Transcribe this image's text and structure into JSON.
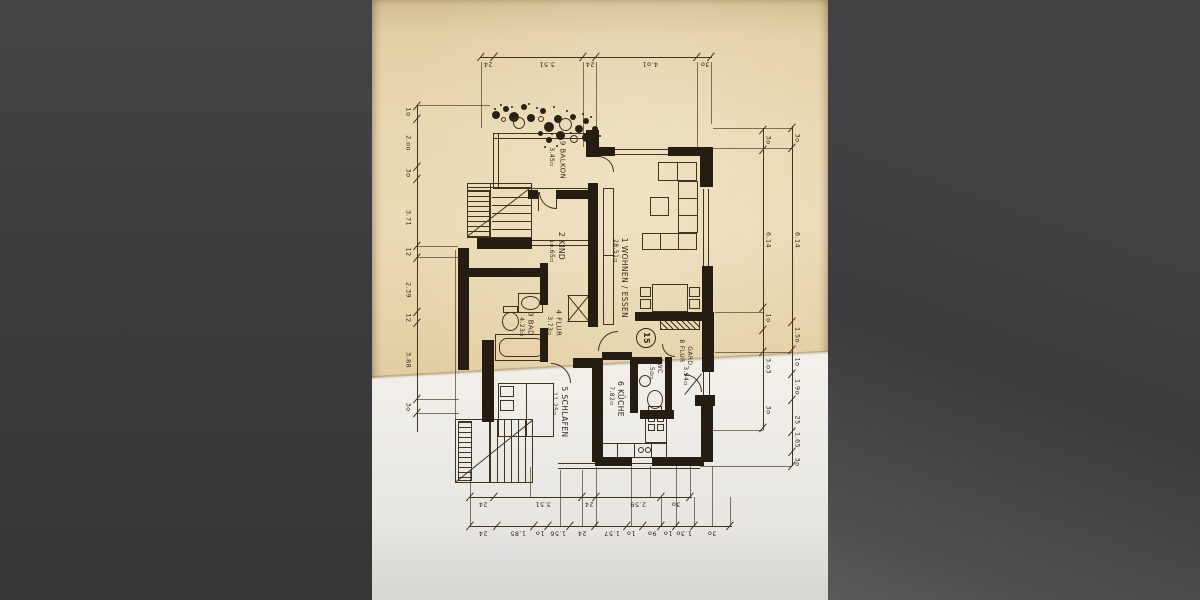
{
  "scene": {
    "description": "photograph of a folded German apartment floor-plan letter, unit 15",
    "letterbox_color": "#3d3d3f",
    "paper_tan": "#e8d4ab",
    "paper_white": "#efede9",
    "ink": "#33281a"
  },
  "unit_badge": {
    "label": "15",
    "x": 646,
    "y": 338,
    "r": 10
  },
  "rooms": [
    {
      "key": "balkon",
      "name": "9 BALKON",
      "area": "3.45▫",
      "nx": 562,
      "ny": 160,
      "ax": 551,
      "ay": 157,
      "fs": 7
    },
    {
      "key": "kind",
      "name": "2 KIND",
      "area": "1o.65▫",
      "nx": 561,
      "ny": 246,
      "ax": 551,
      "ay": 251,
      "fs": 7.5
    },
    {
      "key": "wohnen",
      "name": "1 WOHNEN / ESSEN",
      "area": "28.51▫",
      "nx": 624,
      "ny": 278,
      "ax": 615,
      "ay": 251,
      "fs": 7.5
    },
    {
      "key": "flur",
      "name": "4 FLUR",
      "area": "3.73▫",
      "nx": 558,
      "ny": 323,
      "ax": 549,
      "ay": 326,
      "fs": 7
    },
    {
      "key": "bad",
      "name": "3 BAD",
      "area": "4.23▫",
      "nx": 530,
      "ny": 324,
      "ax": 521,
      "ay": 327,
      "fs": 7
    },
    {
      "key": "schlafen",
      "name": "5 SCHLAFEN",
      "area": "11.25▫",
      "nx": 564,
      "ny": 412,
      "ax": 554,
      "ay": 404,
      "fs": 7.5
    },
    {
      "key": "kueche",
      "name": "6 KÜCHE",
      "area": "7.82▫",
      "nx": 620,
      "ny": 399,
      "ax": 611,
      "ay": 396,
      "fs": 7.5
    },
    {
      "key": "wc",
      "name": "7WC",
      "area": "1.5o▫",
      "nx": 659,
      "ny": 366,
      "ax": 651,
      "ay": 370,
      "fs": 6
    },
    {
      "key": "gard",
      "name": "8 FLUR",
      "name2": "GARD.",
      "area": "3.94▫",
      "nx": 681,
      "ny": 351,
      "n2x": 689,
      "n2y": 357,
      "ax": 685,
      "ay": 376,
      "fs": 6
    }
  ],
  "dims": {
    "chains": [
      {
        "id": "top",
        "dir": "h",
        "x": 480,
        "y": 57,
        "len": 232,
        "rot": 180,
        "off": 7,
        "fs": 6.5,
        "labels": [
          [
            "24",
            488
          ],
          [
            "3.51",
            547
          ],
          [
            "24",
            590
          ],
          [
            "4.o1",
            650
          ],
          [
            "3o",
            705
          ]
        ],
        "ticks": [
          481,
          494,
          583,
          596,
          697,
          711
        ]
      },
      {
        "id": "bottom-inner",
        "dir": "h",
        "x": 470,
        "y": 497,
        "len": 222,
        "rot": 180,
        "off": 7,
        "fs": 6.5,
        "labels": [
          [
            "24",
            483
          ],
          [
            "3.51",
            543
          ],
          [
            "24",
            589
          ],
          [
            "2.59",
            638
          ],
          [
            "3o",
            676
          ]
        ],
        "ticks": [
          470,
          494,
          582,
          596,
          661,
          690
        ]
      },
      {
        "id": "bottom-outer",
        "dir": "h",
        "x": 470,
        "y": 526,
        "len": 262,
        "rot": 180,
        "off": 7,
        "fs": 6.5,
        "labels": [
          [
            "24",
            483
          ],
          [
            "1.85",
            518
          ],
          [
            "1o",
            540
          ],
          [
            "1.56",
            558
          ],
          [
            "24",
            582
          ],
          [
            "1.57",
            612
          ],
          [
            "1o",
            631
          ],
          [
            "9o",
            652
          ],
          [
            "1o",
            668
          ],
          [
            "1.3o",
            684
          ],
          [
            "3o",
            712
          ]
        ],
        "ticks": [
          470,
          497,
          534,
          548,
          570,
          595,
          627,
          643,
          661,
          676,
          694,
          730
        ]
      },
      {
        "id": "left",
        "dir": "v",
        "x": 417,
        "y": 105,
        "len": 327,
        "rot": 90,
        "off": -9,
        "fs": 6.5,
        "labels": [
          [
            "1o",
            112
          ],
          [
            "2.oo",
            143
          ],
          [
            "3o",
            173
          ],
          [
            "3.71",
            218
          ],
          [
            "12",
            252
          ],
          [
            "2.39",
            290
          ],
          [
            "12",
            318
          ],
          [
            "3.88",
            360
          ],
          [
            "3o",
            407
          ]
        ],
        "ticks": [
          106,
          119,
          167,
          179,
          246,
          258,
          312,
          323,
          399,
          413
        ]
      },
      {
        "id": "right-inner",
        "dir": "v",
        "x": 763,
        "y": 128,
        "len": 302,
        "rot": 90,
        "off": 5,
        "fs": 6.5,
        "labels": [
          [
            "3o",
            140
          ],
          [
            "6.14",
            240
          ],
          [
            "1o",
            318
          ],
          [
            "3.o3",
            366
          ],
          [
            "3o",
            410
          ]
        ],
        "ticks": [
          130,
          150,
          308,
          330,
          352,
          428
        ]
      },
      {
        "id": "right-outer",
        "dir": "v",
        "x": 792,
        "y": 126,
        "len": 340,
        "rot": 90,
        "off": 5,
        "fs": 6.5,
        "labels": [
          [
            "3o",
            138
          ],
          [
            "6.14",
            240
          ],
          [
            "1.5o",
            335
          ],
          [
            "1o",
            362
          ],
          [
            "1.9o",
            387
          ],
          [
            "25",
            420
          ],
          [
            "1.65",
            440
          ],
          [
            "3o",
            462
          ]
        ],
        "ticks": [
          128,
          148,
          322,
          350,
          374,
          400,
          432,
          452,
          466
        ]
      }
    ]
  },
  "drawing": {
    "walls": [
      [
        586,
        130,
        13,
        27
      ],
      [
        598,
        147,
        17,
        9
      ],
      [
        668,
        147,
        45,
        9
      ],
      [
        700,
        147,
        13,
        40
      ],
      [
        702,
        266,
        11,
        56
      ],
      [
        635,
        312,
        67,
        9
      ],
      [
        702,
        312,
        12,
        60
      ],
      [
        695,
        395,
        20,
        11
      ],
      [
        701,
        404,
        12,
        58
      ],
      [
        588,
        183,
        10,
        144
      ],
      [
        528,
        190,
        10,
        9
      ],
      [
        556,
        190,
        36,
        9
      ],
      [
        477,
        238,
        55,
        11
      ],
      [
        458,
        248,
        11,
        122
      ],
      [
        462,
        268,
        80,
        9
      ],
      [
        540,
        263,
        8,
        42
      ],
      [
        540,
        328,
        8,
        34
      ],
      [
        482,
        340,
        12,
        82
      ],
      [
        573,
        358,
        30,
        10
      ],
      [
        592,
        358,
        11,
        104
      ],
      [
        602,
        352,
        30,
        8
      ],
      [
        630,
        357,
        8,
        56
      ],
      [
        630,
        357,
        32,
        7
      ],
      [
        665,
        357,
        7,
        53
      ],
      [
        640,
        410,
        34,
        9
      ],
      [
        595,
        457,
        37,
        9
      ],
      [
        652,
        457,
        52,
        9
      ]
    ],
    "lines": [
      [
        493,
        133,
        95,
        1
      ],
      [
        493,
        138,
        95,
        1
      ],
      [
        493,
        133,
        1,
        56
      ],
      [
        498,
        133,
        1,
        56
      ],
      [
        493,
        188,
        96,
        1
      ],
      [
        614,
        149,
        54,
        1
      ],
      [
        614,
        154,
        54,
        1
      ],
      [
        703,
        189,
        1,
        78
      ],
      [
        708,
        189,
        1,
        78
      ],
      [
        703,
        372,
        1,
        25
      ],
      [
        709,
        372,
        1,
        25
      ],
      [
        558,
        463,
        142,
        1
      ],
      [
        558,
        468,
        142,
        1
      ],
      [
        532,
        240,
        60,
        1
      ],
      [
        532,
        245,
        60,
        1
      ],
      [
        467,
        183,
        65,
        1
      ],
      [
        467,
        187,
        65,
        1
      ],
      [
        490,
        183,
        1,
        55
      ],
      [
        492,
        197,
        40,
        1
      ],
      [
        492,
        205,
        40,
        1
      ],
      [
        492,
        213,
        40,
        1
      ],
      [
        492,
        221,
        40,
        1
      ],
      [
        492,
        229,
        40,
        1
      ],
      [
        526,
        383,
        1,
        54
      ],
      [
        603,
        255,
        11,
        1
      ],
      [
        617,
        443,
        1,
        15
      ],
      [
        634,
        443,
        1,
        15
      ],
      [
        651,
        443,
        1,
        15
      ],
      [
        677,
        162,
        1,
        19
      ],
      [
        678,
        198,
        20,
        1
      ],
      [
        678,
        215,
        20,
        1
      ],
      [
        660,
        233,
        1,
        17
      ],
      [
        678,
        233,
        1,
        17
      ],
      [
        556,
        192,
        1,
        17
      ],
      [
        538,
        192,
        1,
        19
      ]
    ],
    "ext": [
      [
        481,
        62,
        1,
        66
      ],
      [
        583,
        62,
        1,
        85
      ],
      [
        596,
        62,
        1,
        85
      ],
      [
        697,
        62,
        1,
        85
      ],
      [
        711,
        62,
        1,
        62
      ],
      [
        417,
        105,
        73,
        1
      ],
      [
        417,
        246,
        41,
        1
      ],
      [
        417,
        257,
        41,
        1
      ],
      [
        417,
        399,
        42,
        1
      ],
      [
        417,
        413,
        42,
        1
      ],
      [
        713,
        128,
        79,
        1
      ],
      [
        713,
        148,
        79,
        1
      ],
      [
        715,
        312,
        48,
        1
      ],
      [
        715,
        352,
        77,
        1
      ],
      [
        713,
        430,
        50,
        1
      ],
      [
        700,
        466,
        92,
        1
      ],
      [
        455,
        250,
        1,
        170
      ],
      [
        470,
        470,
        1,
        57
      ],
      [
        530,
        467,
        1,
        30
      ],
      [
        560,
        470,
        1,
        56
      ],
      [
        582,
        470,
        1,
        56
      ],
      [
        596,
        467,
        1,
        59
      ],
      [
        631,
        466,
        1,
        60
      ],
      [
        650,
        466,
        1,
        31
      ],
      [
        661,
        497,
        1,
        29
      ],
      [
        676,
        466,
        1,
        60
      ],
      [
        690,
        466,
        1,
        31
      ],
      [
        694,
        497,
        1,
        29
      ],
      [
        712,
        466,
        1,
        60
      ],
      [
        730,
        497,
        1,
        29
      ]
    ],
    "rects": [
      [
        467,
        183,
        65,
        55
      ],
      [
        455,
        419,
        78,
        64
      ],
      [
        603,
        188,
        11,
        137
      ],
      [
        658,
        162,
        39,
        19
      ],
      [
        678,
        181,
        20,
        52
      ],
      [
        642,
        233,
        55,
        17
      ],
      [
        650,
        197,
        19,
        19
      ],
      [
        652,
        284,
        36,
        28
      ],
      [
        640,
        287,
        11,
        10
      ],
      [
        640,
        299,
        11,
        10
      ],
      [
        689,
        287,
        11,
        10
      ],
      [
        689,
        299,
        11,
        10
      ],
      [
        568,
        295,
        22,
        27
      ],
      [
        518,
        293,
        25,
        20
      ],
      [
        503,
        306,
        15,
        7
      ],
      [
        495,
        334,
        53,
        27
      ],
      [
        498,
        383,
        56,
        54
      ],
      [
        500,
        386,
        14,
        11
      ],
      [
        500,
        400,
        14,
        11
      ],
      [
        645,
        412,
        22,
        31
      ],
      [
        648,
        415,
        7,
        7
      ],
      [
        657,
        415,
        7,
        7
      ],
      [
        648,
        424,
        7,
        7
      ],
      [
        657,
        424,
        7,
        7
      ],
      [
        600,
        443,
        67,
        15
      ],
      [
        648,
        406,
        14,
        7
      ]
    ],
    "rounds": [
      [
        499,
        338,
        45,
        19
      ]
    ],
    "ovals": [
      [
        521,
        296,
        19,
        14
      ],
      [
        502,
        312,
        17,
        19
      ],
      [
        639,
        375,
        12,
        12
      ],
      [
        647,
        390,
        16,
        19
      ],
      [
        638,
        447,
        6,
        6
      ],
      [
        645,
        447,
        6,
        6
      ]
    ],
    "hatches": [
      {
        "x": 467,
        "y": 190,
        "w": 23,
        "h": 47,
        "dir": "h"
      },
      {
        "x": 458,
        "y": 421,
        "w": 14,
        "h": 60,
        "dir": "h"
      },
      {
        "x": 489,
        "y": 419,
        "w": 44,
        "h": 64,
        "dir": "v"
      },
      {
        "x": 660,
        "y": 320,
        "w": 40,
        "h": 10,
        "dir": "d"
      }
    ],
    "diags": [
      [
        467,
        236,
        532,
        186
      ],
      [
        455,
        482,
        532,
        420
      ],
      [
        702,
        374,
        685,
        395
      ],
      [
        568,
        295,
        590,
        322
      ],
      [
        590,
        295,
        568,
        322
      ]
    ],
    "arcs": [
      {
        "x": 539,
        "y": 192,
        "w": 17,
        "h": 17,
        "c": "bl"
      },
      {
        "x": 598,
        "y": 156,
        "w": 16,
        "h": 16,
        "c": "tr"
      },
      {
        "x": 598,
        "y": 331,
        "w": 20,
        "h": 20,
        "c": "tl"
      },
      {
        "x": 551,
        "y": 363,
        "w": 20,
        "h": 20,
        "c": "tr"
      },
      {
        "x": 684,
        "y": 374,
        "w": 18,
        "h": 18,
        "c": "tr"
      },
      {
        "x": 662,
        "y": 344,
        "w": 13,
        "h": 13,
        "c": "bl"
      }
    ],
    "plants_filled": [
      [
        496,
        115,
        8
      ],
      [
        506,
        109,
        6
      ],
      [
        514,
        117,
        10
      ],
      [
        524,
        107,
        6
      ],
      [
        531,
        118,
        8
      ],
      [
        543,
        111,
        6
      ],
      [
        549,
        127,
        10
      ],
      [
        558,
        119,
        8
      ],
      [
        573,
        117,
        6
      ],
      [
        579,
        129,
        8
      ],
      [
        586,
        121,
        6
      ],
      [
        560,
        135,
        9
      ],
      [
        586,
        137,
        9
      ],
      [
        595,
        129,
        6
      ],
      [
        549,
        140,
        6
      ],
      [
        540,
        133,
        5
      ]
    ],
    "plants_outline": [
      [
        519,
        123,
        12
      ],
      [
        565,
        124,
        13
      ],
      [
        574,
        139,
        8
      ],
      [
        595,
        141,
        8
      ],
      [
        541,
        119,
        6
      ],
      [
        503,
        119,
        5
      ]
    ],
    "plant_dots": [
      [
        494,
        108
      ],
      [
        500,
        104
      ],
      [
        511,
        106
      ],
      [
        528,
        103
      ],
      [
        536,
        107
      ],
      [
        553,
        106
      ],
      [
        566,
        110
      ],
      [
        582,
        113
      ],
      [
        590,
        116
      ],
      [
        551,
        133
      ],
      [
        570,
        132
      ],
      [
        599,
        135
      ],
      [
        544,
        146
      ],
      [
        556,
        145
      ]
    ]
  }
}
